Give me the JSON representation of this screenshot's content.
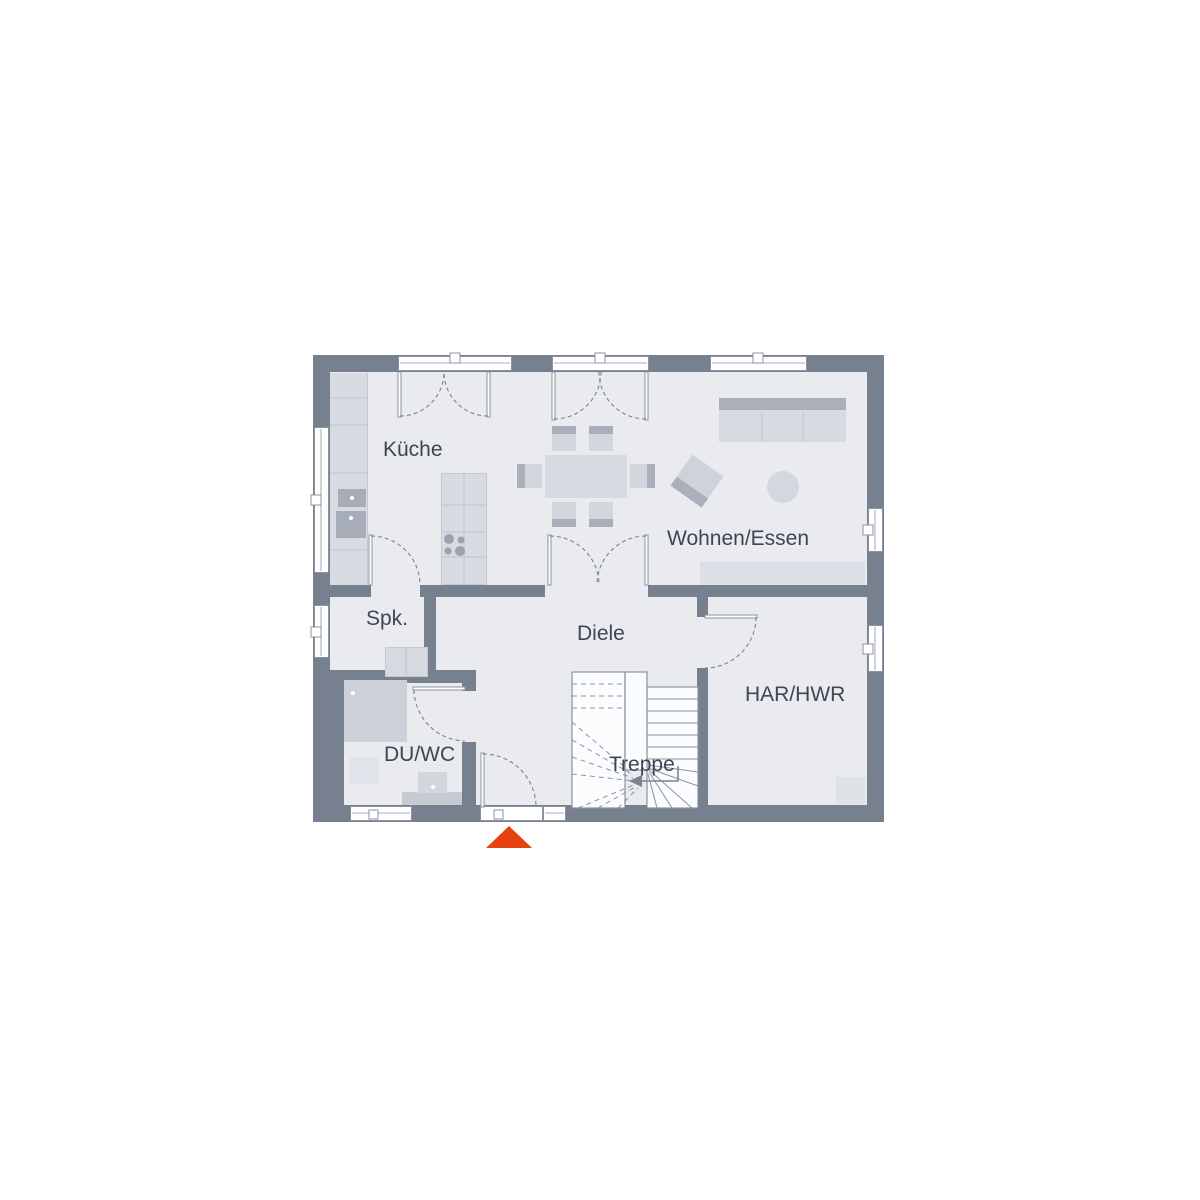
{
  "plan": {
    "type": "floor-plan",
    "rooms": {
      "kueche": {
        "label": "Küche"
      },
      "wohnen_essen": {
        "label": "Wohnen/Essen"
      },
      "spk": {
        "label": "Spk."
      },
      "diele": {
        "label": "Diele"
      },
      "du_wc": {
        "label": "DU/WC"
      },
      "har_hwr": {
        "label": "HAR/HWR"
      },
      "treppe": {
        "label": "Treppe"
      }
    },
    "markers": {
      "entrance": {
        "icon": "entrance-triangle-marker",
        "color": "#e5420f"
      },
      "stair_direction": {
        "icon": "left-arrow",
        "color": "#7a8290"
      }
    },
    "colors": {
      "wall": "#76808e",
      "floor": "#e9ebef",
      "furniture_light": "#d8dbe2",
      "furniture_mid": "#cdd1d9",
      "furniture_dark": "#a9b0bc",
      "outline": "#8b93a0",
      "text": "#3e4554",
      "accent": "#e5420f",
      "background": "#ffffff"
    }
  }
}
